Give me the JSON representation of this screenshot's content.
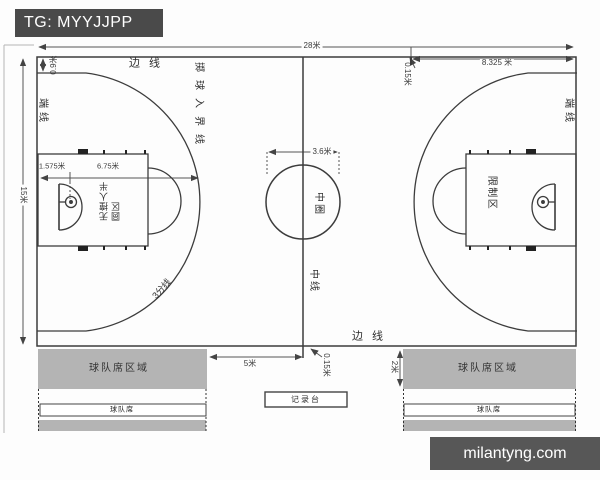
{
  "badge": {
    "text": "TG: MYYJJPP"
  },
  "watermark": {
    "text": "milantyng.com"
  },
  "colors": {
    "badge_bg": "#4a4a4a",
    "watermark_bg": "#575757",
    "bench_gray": "#b4b4b4",
    "line": "#3c3c3c"
  },
  "court": {
    "dimensions": {
      "length": "28米",
      "width": "15米",
      "throw_in_from_endline": "8.325 米",
      "mark_length_top": "0.15米",
      "sideline_to_three_point": "0.9米",
      "endline_to_basket": "1.575米",
      "three_point_radius": "6.75米",
      "center_circle": "3.6米",
      "bench_to_center": "5米",
      "mark_length_bottom": "0.15米",
      "bench_depth": "2米"
    },
    "labels": {
      "sideline_top": "边 线",
      "sideline_bottom": "边 线",
      "endline_left": "端线",
      "endline_right": "端线",
      "throw_in_line": "掷球入界线",
      "center_circle": "中圈",
      "center_line": "中线",
      "no_charge_semicircle": "无撞人半圆区",
      "restricted_area": "限制区",
      "three_point_line": "3分线",
      "bench_area_left": "球队席区域",
      "bench_area_right": "球队席区域",
      "bench_left": "球队席",
      "bench_right": "球队席",
      "scorer_table": "记录台"
    }
  }
}
